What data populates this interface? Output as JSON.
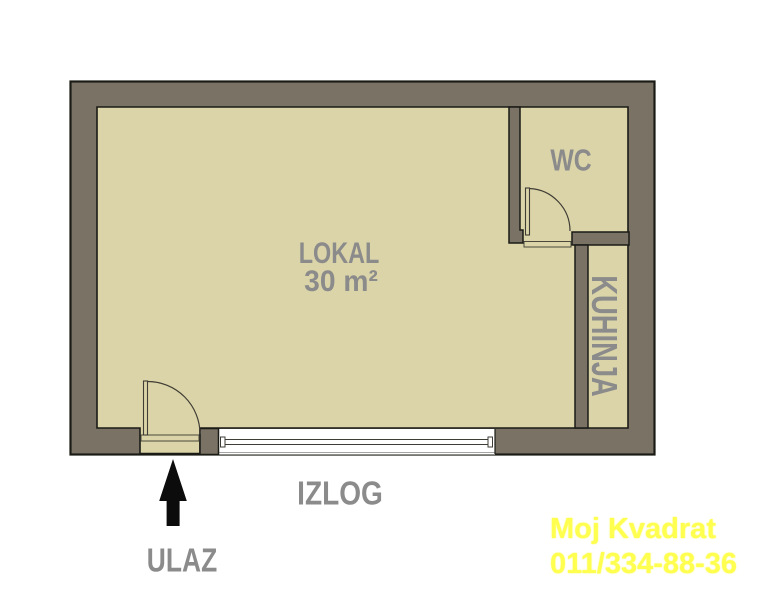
{
  "rooms": {
    "lokal": {
      "label": "LOKAL",
      "area": "30 m²"
    },
    "wc": {
      "label": "WC"
    },
    "kuhinja": {
      "label": "KUHINJA"
    }
  },
  "annotations": {
    "window_label": "IZLOG",
    "entrance_label": "ULAZ"
  },
  "watermark": {
    "line1": "Moj Kvadrat",
    "line2": "011/334-88-36"
  },
  "icons": {
    "entrance_arrow": "arrow-up"
  },
  "colors": {
    "wall": "#7a7265",
    "floor": "#dbd4a8",
    "outline": "#1b1b16",
    "label": "#8b8b8b",
    "watermark": "#ffff4f",
    "arrow": "#0c0c0c",
    "line": "#3f3d35"
  }
}
